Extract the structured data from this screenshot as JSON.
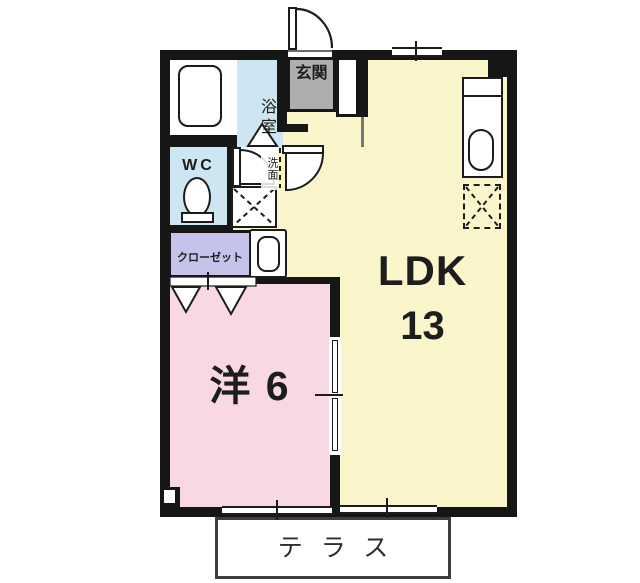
{
  "plan": {
    "rooms": {
      "ldk": {
        "label": "LDK",
        "size": "13"
      },
      "bedroom": {
        "label": "洋 6"
      },
      "bathroom": {
        "label": "浴室"
      },
      "wc": {
        "label": "WC"
      },
      "washroom": {
        "label": "洗面"
      },
      "closet": {
        "label": "クローゼット"
      },
      "entrance": {
        "label": "玄関"
      },
      "terrace": {
        "label": "テラス"
      }
    },
    "colors": {
      "wall": "#161616",
      "outline": "#1c1c1c",
      "ldk": "#FBF5CB",
      "bedroom": "#F8D9E2",
      "water": "#CEE6F1",
      "closet": "#C6C3EB",
      "entrance": "#AEAEB1",
      "terraceBorder": "#3E3E3E"
    }
  }
}
